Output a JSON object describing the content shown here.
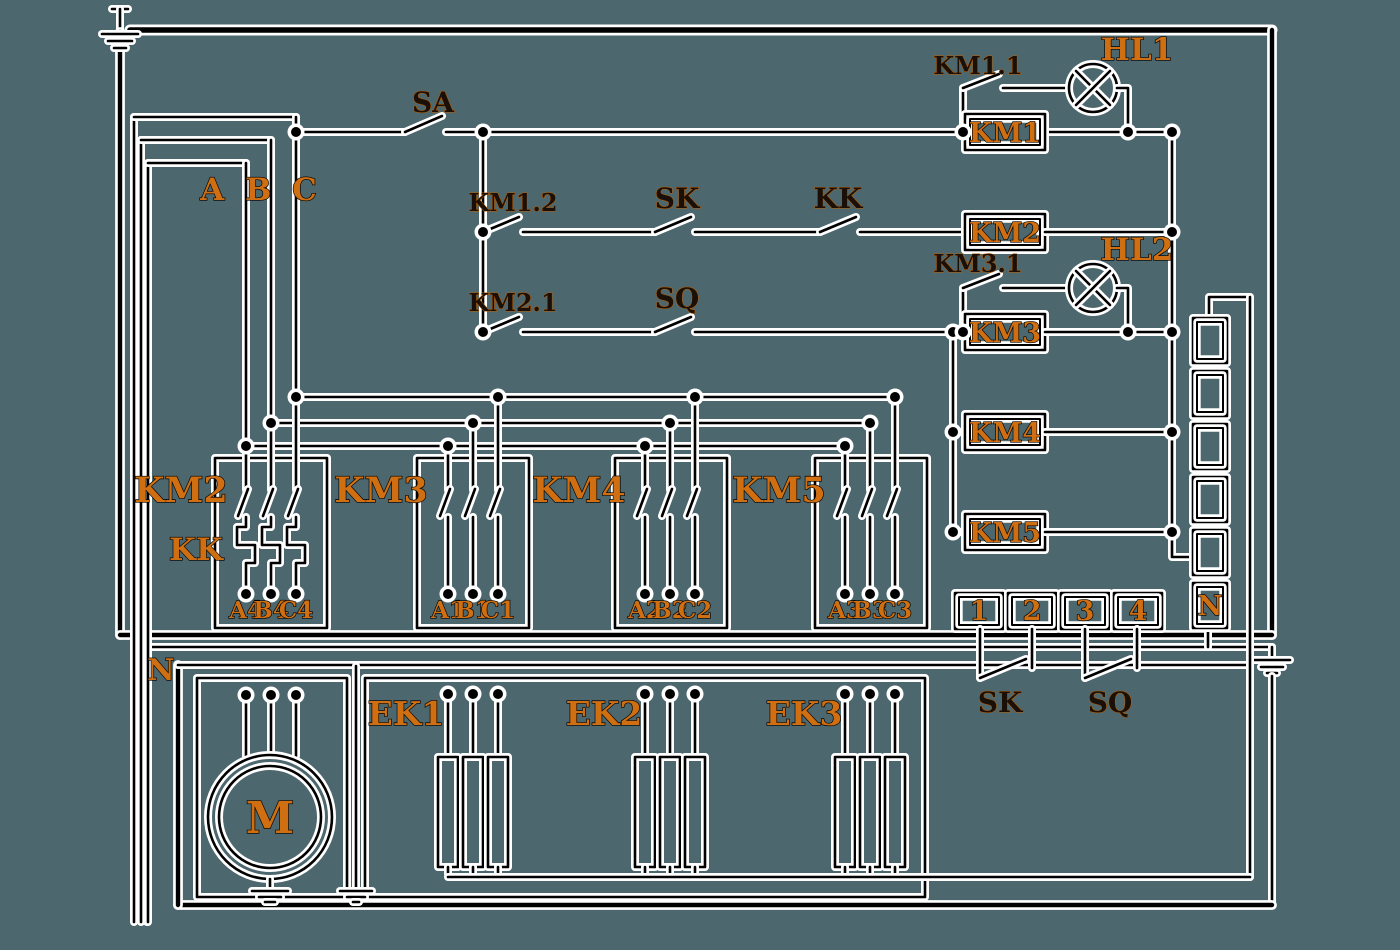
{
  "diagram_type": "electrical-schematic",
  "colors": {
    "background": "#4d676e",
    "line": "#000000",
    "halo": "#ffffff",
    "label_accent": "#cf6f12"
  },
  "symbols": {
    "ground": "earth-ground-icon",
    "lamp": "indicator-lamp-icon",
    "motor": "motor-icon",
    "heater": "thermal-element-icon"
  },
  "labels": {
    "phase_abc": "A B C",
    "neutral_left": "N",
    "sa": "SA",
    "km11": "KM1.1",
    "hl1": "HL1",
    "km12": "KM1.2",
    "sk_row": "SK",
    "kk_row": "KK",
    "km21": "KM2.1",
    "sq_row": "SQ",
    "km31": "KM3.1",
    "hl2": "HL2",
    "kk_side": "KK",
    "sk_bottom": "SK",
    "sq_bottom": "SQ",
    "terminal_n": "N"
  },
  "coils": [
    "KM1",
    "KM2",
    "KM3",
    "KM4",
    "KM5"
  ],
  "contactors": [
    {
      "label": "KM2",
      "outputs": [
        "A4",
        "B4",
        "C4"
      ]
    },
    {
      "label": "KM3",
      "outputs": [
        "A1",
        "B1",
        "C1"
      ]
    },
    {
      "label": "KM4",
      "outputs": [
        "A2",
        "B2",
        "C2"
      ]
    },
    {
      "label": "KM5",
      "outputs": [
        "A3",
        "B3",
        "C3"
      ]
    }
  ],
  "heaters": [
    "EK1",
    "EK2",
    "EK3"
  ],
  "motor": "M",
  "terminals": [
    "1",
    "2",
    "3",
    "4"
  ]
}
